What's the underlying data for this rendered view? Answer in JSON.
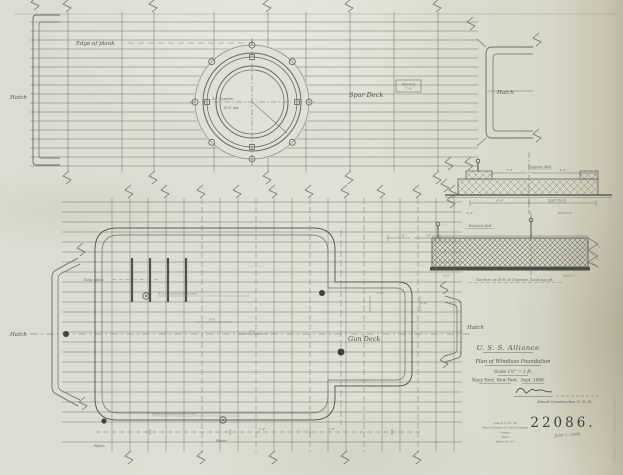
{
  "labels": {
    "hatch": "Hatch",
    "spar_deck": "Spar Deck",
    "gun_deck": "Gun Deck",
    "edge_of_plank": "Edge of plank",
    "edge_plank": "Edge plank",
    "opening_note": "Opening",
    "opening_size": "7'-0\"",
    "capstan_bed": "Capstan Bed",
    "wooden_bed": "Wooden Bed",
    "section_caption": "Section at B-B of Capstan, looking aft.",
    "beam": "Beam"
  },
  "annotations": {
    "capstan_center": "10\" Capstan",
    "circle_dia": "4'-0\" dia.",
    "angle_iron": "4\" x 3\" x 8.5 lb angle iron",
    "foundation_plate": "Steel foundation plate 15 lbs",
    "dim_9_4": "9'-4\"",
    "dim_3_9": "3'-9\"",
    "dim_4_6": "4'-6\"",
    "teak_4_6": "Teak 4'-6\"",
    "dim_4_2": "4'-2\"",
    "teak_4_1": "Teak 4'-1\"",
    "dim_2_6": "2'-6\"",
    "dim_3_0": "3'-0\"",
    "dim_1_4": "1'-4\"",
    "dim_1_0": "1'-0\"",
    "dim_1_8": "1'-8\"",
    "dim_10": "10\"",
    "dim_2_0": "2'-0\""
  },
  "title_block": {
    "ship": "U. S. S. Alliance",
    "drawing_title": "Plan of Windlass Foundation",
    "scale": "Scale 1½\" = 1 ft.",
    "yard": "Navy Yard, New York.",
    "date": "Sept. 1896.",
    "signer_title": "Naval Constructor, U. S. N.",
    "drawing_number": "22086.",
    "filing_date": "June 1, 1896."
  },
  "stamp": {
    "line1": "Case P, F. No. 48",
    "line2": "Plans of Bureau of Constr. & Repair",
    "line3": "·  ·  Frames  ·  ·",
    "line4": "·  ·  Plans  ·  ·",
    "line5": "·  ·  Sheets No. 14  ·  ·"
  },
  "margin_note": "Alliance — Windlass Foundation"
}
